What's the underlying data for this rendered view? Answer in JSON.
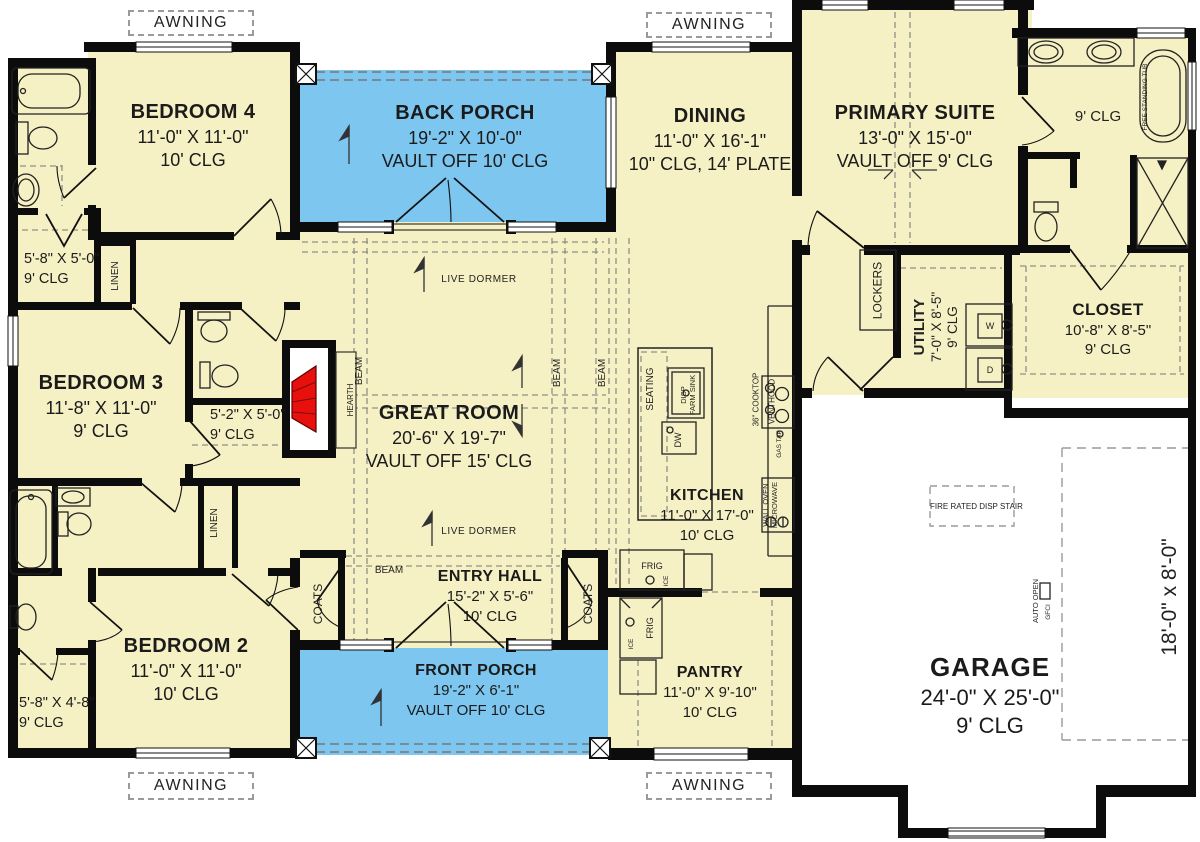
{
  "colors": {
    "floor": "#F6F1C4",
    "porch_blue": "#7CC6EF",
    "wall_black": "#0C0C0C",
    "fireplace_red": "#E8100C",
    "background": "#FFFFFF"
  },
  "rooms": {
    "bedroom4": {
      "name": "BEDROOM 4",
      "dims": "11'-0\" X 11'-0\"",
      "ceiling": "10' CLG"
    },
    "back_porch": {
      "name": "BACK PORCH",
      "dims": "19'-2\" X 10'-0\"",
      "ceiling": "VAULT OFF 10' CLG"
    },
    "dining": {
      "name": "DINING",
      "dims": "11'-0\" X 16'-1\"",
      "ceiling": "10\" CLG, 14' PLATE"
    },
    "primary_suite": {
      "name": "PRIMARY SUITE",
      "dims": "13'-0\" X 15'-0\"",
      "ceiling": "VAULT OFF 9' CLG"
    },
    "primary_bath": {
      "ceiling": "9' CLG"
    },
    "closet": {
      "name": "CLOSET",
      "dims": "10'-8\" X 8'-5\"",
      "ceiling": "9' CLG"
    },
    "utility": {
      "name": "UTILITY",
      "dims": "7'-0\" X 8'-5\"",
      "ceiling": "9' CLG"
    },
    "great_room": {
      "name": "GREAT ROOM",
      "dims": "20'-6\" X 19'-7\"",
      "ceiling": "VAULT OFF 15' CLG"
    },
    "kitchen": {
      "name": "KITCHEN",
      "dims": "11'-0\" X 17'-0\"",
      "ceiling": "10' CLG"
    },
    "entry_hall": {
      "name": "ENTRY HALL",
      "dims": "15'-2\" X 5'-6\"",
      "ceiling": "10' CLG"
    },
    "front_porch": {
      "name": "FRONT PORCH",
      "dims": "19'-2\" X 6'-1\"",
      "ceiling": "VAULT OFF 10' CLG"
    },
    "bedroom3": {
      "name": "BEDROOM 3",
      "dims": "11'-8\" X 11'-0\"",
      "ceiling": "9' CLG"
    },
    "bedroom2": {
      "name": "BEDROOM 2",
      "dims": "11'-0\" X 11'-0\"",
      "ceiling": "10' CLG"
    },
    "pantry": {
      "name": "PANTRY",
      "dims": "11'-0\" X 9'-10\"",
      "ceiling": "10' CLG"
    },
    "garage": {
      "name": "GARAGE",
      "dims": "24'-0\" X 25'-0\"",
      "ceiling": "9' CLG"
    }
  },
  "closets": {
    "bedroom4_closet": {
      "dims": "5'-8\" X 5'-0\"",
      "ceiling": "9' CLG"
    },
    "bedroom3_closet": {
      "dims": "5'-2\" X 5'-0\"",
      "ceiling": "9' CLG"
    },
    "bedroom2_closet": {
      "dims": "5'-8\" X 4'-8\"",
      "ceiling": "9' CLG"
    }
  },
  "annotations": {
    "awning": "AWNING",
    "linen": "LINEN",
    "coats": "COATS",
    "beam": "BEAM",
    "hearth": "HEARTH",
    "live_dormer": "LIVE DORMER",
    "lockers": "LOCKERS",
    "seating": "SEATING",
    "disp": "DISP",
    "farm_sink": "FARM SINK",
    "dw": "DW",
    "frig": "FRIG",
    "ice": "ICE",
    "cooktop": "36\" COOKTOP",
    "venthood": "VENTHOOD",
    "gas_tap": "GAS TAP",
    "wall_oven": "WALL OVEN",
    "microwave": "MICROWAVE",
    "free_standing_tub": "FREE STANDING TUB",
    "fire_rated_stair": "FIRE RATED DISP STAIR",
    "auto_open": "AUTO OPEN",
    "gfci": "GFCI",
    "garage_door_size": "18'-0\" x 8'-0\"",
    "washer": "W",
    "dryer": "D"
  }
}
